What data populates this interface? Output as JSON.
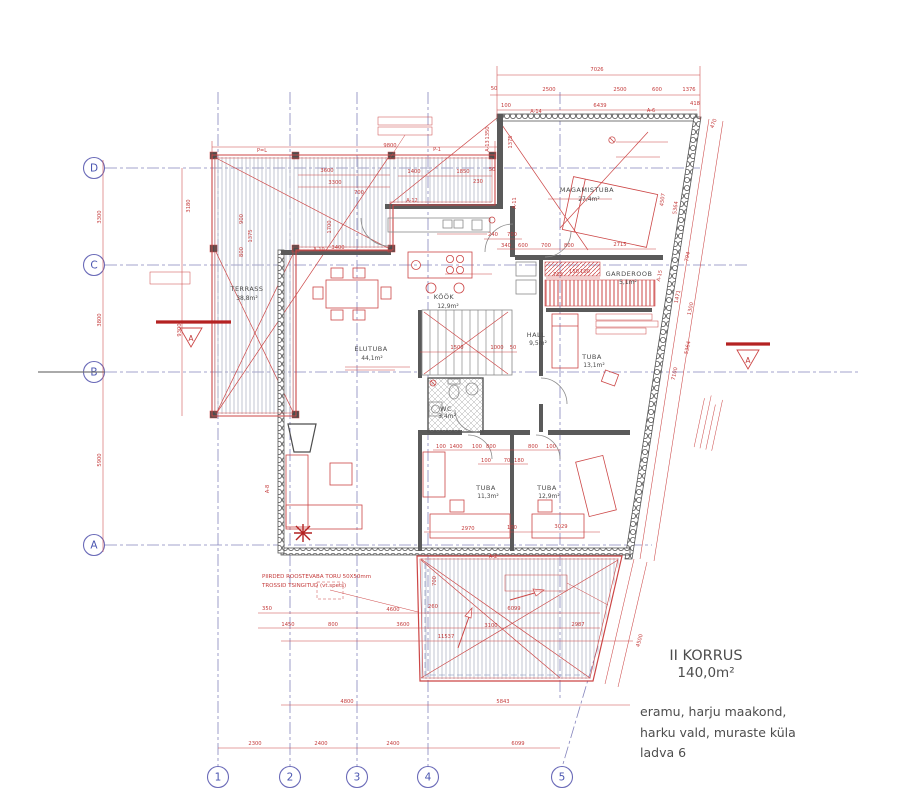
{
  "title_block": {
    "floor_label": "II KORRUS",
    "floor_area": "140,0m²",
    "address_line1": "eramu, harju maakond,",
    "address_line2": "harku vald, muraste küla",
    "address_line3": "ladva 6"
  },
  "rooms": [
    {
      "name": "TERRASS",
      "area": "38,8m²"
    },
    {
      "name": "MAGAMISTUBA",
      "area": "27,4m²"
    },
    {
      "name": "KÖÖK",
      "area": "12,9m²"
    },
    {
      "name": "ELUTUBA",
      "area": "44,1m²"
    },
    {
      "name": "GARDEROOB",
      "area": "5,1m²"
    },
    {
      "name": "HALL",
      "area": "9,5m²"
    },
    {
      "name": "TUBA",
      "area": "13,1m²"
    },
    {
      "name": "WC",
      "area": "3,4m²"
    },
    {
      "name": "TUBA",
      "area": "11,3m²"
    },
    {
      "name": "TUBA",
      "area": "12,9m²"
    }
  ],
  "section": {
    "label": "A"
  },
  "notes": {
    "railing_line1": "PIIRDED ROOSTEVABA TORU 50X50mm",
    "railing_line2": "TROSSID TSINGITUD (vt.spets)"
  },
  "grid": {
    "rows": [
      {
        "label": "D",
        "y": 168,
        "x1": 105,
        "x2": 700
      },
      {
        "label": "C",
        "y": 265,
        "x1": 105,
        "x2": 748
      },
      {
        "label": "B",
        "y": 372,
        "x1": 105,
        "x2": 858
      },
      {
        "label": "A",
        "y": 545,
        "x1": 105,
        "x2": 652
      }
    ],
    "cols": [
      {
        "label": "1",
        "x": 218,
        "y1": 92,
        "y2": 766
      },
      {
        "label": "2",
        "x": 290,
        "y1": 92,
        "y2": 766
      },
      {
        "label": "3",
        "x": 357,
        "y1": 92,
        "y2": 766
      },
      {
        "label": "4",
        "x": 428,
        "y1": 92,
        "y2": 766
      },
      {
        "label": "5",
        "x": 560,
        "y1": 92,
        "y2": 700
      }
    ]
  },
  "detail_tags": [
    {
      "t": "A-14",
      "x": 536,
      "y": 113
    },
    {
      "t": "A-6",
      "x": 651,
      "y": 112
    },
    {
      "t": "P=L",
      "x": 262,
      "y": 152
    },
    {
      "t": "P-1",
      "x": 437,
      "y": 151
    },
    {
      "t": "A-13",
      "x": 489,
      "y": 146,
      "r": -90
    },
    {
      "t": "A-12",
      "x": 412,
      "y": 202
    },
    {
      "t": "A-11",
      "x": 516,
      "y": 203,
      "r": -90
    },
    {
      "t": "A-10",
      "x": 319,
      "y": 251
    },
    {
      "t": "A-8",
      "x": 269,
      "y": 489,
      "r": -90
    },
    {
      "t": "A-2",
      "x": 493,
      "y": 558
    },
    {
      "t": "A-15",
      "x": 661,
      "y": 276,
      "r": -78
    }
  ],
  "dimensions": [
    {
      "t": "7026",
      "x": 597,
      "y": 71
    },
    {
      "t": "50",
      "x": 494,
      "y": 90
    },
    {
      "t": "2500",
      "x": 549,
      "y": 91
    },
    {
      "t": "2500",
      "x": 620,
      "y": 91
    },
    {
      "t": "600",
      "x": 657,
      "y": 91
    },
    {
      "t": "1376",
      "x": 689,
      "y": 91
    },
    {
      "t": "100",
      "x": 506,
      "y": 107
    },
    {
      "t": "6439",
      "x": 600,
      "y": 107
    },
    {
      "t": "418",
      "x": 695,
      "y": 105
    },
    {
      "t": "9800",
      "x": 390,
      "y": 147
    },
    {
      "t": "3600",
      "x": 327,
      "y": 172
    },
    {
      "t": "3300",
      "x": 335,
      "y": 184
    },
    {
      "t": "700",
      "x": 359,
      "y": 194
    },
    {
      "t": "3400",
      "x": 338,
      "y": 249
    },
    {
      "t": "1700",
      "x": 331,
      "y": 227,
      "r": -90
    },
    {
      "t": "900",
      "x": 243,
      "y": 219,
      "r": -90
    },
    {
      "t": "800",
      "x": 243,
      "y": 252,
      "r": -90
    },
    {
      "t": "1375",
      "x": 252,
      "y": 236,
      "r": -90
    },
    {
      "t": "1400",
      "x": 414,
      "y": 173
    },
    {
      "t": "1850",
      "x": 463,
      "y": 173
    },
    {
      "t": "230",
      "x": 478,
      "y": 183
    },
    {
      "t": "50",
      "x": 492,
      "y": 171
    },
    {
      "t": "1350",
      "x": 489,
      "y": 133,
      "r": -90
    },
    {
      "t": "1375",
      "x": 512,
      "y": 142,
      "r": -90
    },
    {
      "t": "240",
      "x": 493,
      "y": 236
    },
    {
      "t": "700",
      "x": 512,
      "y": 236
    },
    {
      "t": "340",
      "x": 506,
      "y": 247
    },
    {
      "t": "600",
      "x": 523,
      "y": 247
    },
    {
      "t": "700",
      "x": 546,
      "y": 247
    },
    {
      "t": "800",
      "x": 569,
      "y": 247
    },
    {
      "t": "2715",
      "x": 620,
      "y": 246
    },
    {
      "t": "705",
      "x": 558,
      "y": 276
    },
    {
      "t": "150",
      "x": 574,
      "y": 273
    },
    {
      "t": "100",
      "x": 585,
      "y": 273
    },
    {
      "t": "4507",
      "x": 664,
      "y": 200,
      "r": -82
    },
    {
      "t": "5364",
      "x": 677,
      "y": 208,
      "r": -82
    },
    {
      "t": "470",
      "x": 715,
      "y": 124,
      "r": -70
    },
    {
      "t": "794",
      "x": 689,
      "y": 257,
      "r": -78
    },
    {
      "t": "1471",
      "x": 679,
      "y": 297,
      "r": -78
    },
    {
      "t": "1300",
      "x": 692,
      "y": 309,
      "r": -78
    },
    {
      "t": "5364",
      "x": 689,
      "y": 348,
      "r": -78
    },
    {
      "t": "7100",
      "x": 676,
      "y": 374,
      "r": -78
    },
    {
      "t": "1500",
      "x": 457,
      "y": 349
    },
    {
      "t": "1000",
      "x": 497,
      "y": 349
    },
    {
      "t": "50",
      "x": 513,
      "y": 349
    },
    {
      "t": "100",
      "x": 441,
      "y": 448
    },
    {
      "t": "1400",
      "x": 456,
      "y": 448
    },
    {
      "t": "100",
      "x": 477,
      "y": 448
    },
    {
      "t": "800",
      "x": 491,
      "y": 448
    },
    {
      "t": "800",
      "x": 533,
      "y": 448
    },
    {
      "t": "100",
      "x": 551,
      "y": 448
    },
    {
      "t": "100",
      "x": 486,
      "y": 462
    },
    {
      "t": "70",
      "x": 507,
      "y": 462
    },
    {
      "t": "180",
      "x": 519,
      "y": 462
    },
    {
      "t": "2970",
      "x": 468,
      "y": 530
    },
    {
      "t": "100",
      "x": 512,
      "y": 529
    },
    {
      "t": "3029",
      "x": 561,
      "y": 528
    },
    {
      "t": "3300",
      "x": 101,
      "y": 217,
      "r": -90
    },
    {
      "t": "3800",
      "x": 101,
      "y": 320,
      "r": -90
    },
    {
      "t": "5900",
      "x": 101,
      "y": 460,
      "r": -90
    },
    {
      "t": "9300",
      "x": 181,
      "y": 330,
      "r": -90
    },
    {
      "t": "3180",
      "x": 190,
      "y": 206,
      "r": -90
    },
    {
      "t": "350",
      "x": 267,
      "y": 610
    },
    {
      "t": "4600",
      "x": 393,
      "y": 611
    },
    {
      "t": "1450",
      "x": 288,
      "y": 626
    },
    {
      "t": "800",
      "x": 333,
      "y": 626
    },
    {
      "t": "3600",
      "x": 403,
      "y": 626
    },
    {
      "t": "260",
      "x": 433,
      "y": 608
    },
    {
      "t": "6099",
      "x": 514,
      "y": 610
    },
    {
      "t": "3100",
      "x": 491,
      "y": 627
    },
    {
      "t": "2987",
      "x": 578,
      "y": 626
    },
    {
      "t": "11537",
      "x": 446,
      "y": 638
    },
    {
      "t": "700",
      "x": 436,
      "y": 581,
      "r": -90
    },
    {
      "t": "4500",
      "x": 641,
      "y": 641,
      "r": -75
    },
    {
      "t": "4800",
      "x": 347,
      "y": 703
    },
    {
      "t": "5843",
      "x": 503,
      "y": 703
    },
    {
      "t": "2300",
      "x": 255,
      "y": 745
    },
    {
      "t": "2400",
      "x": 321,
      "y": 745
    },
    {
      "t": "2400",
      "x": 393,
      "y": 745
    },
    {
      "t": "6099",
      "x": 518,
      "y": 745
    }
  ]
}
